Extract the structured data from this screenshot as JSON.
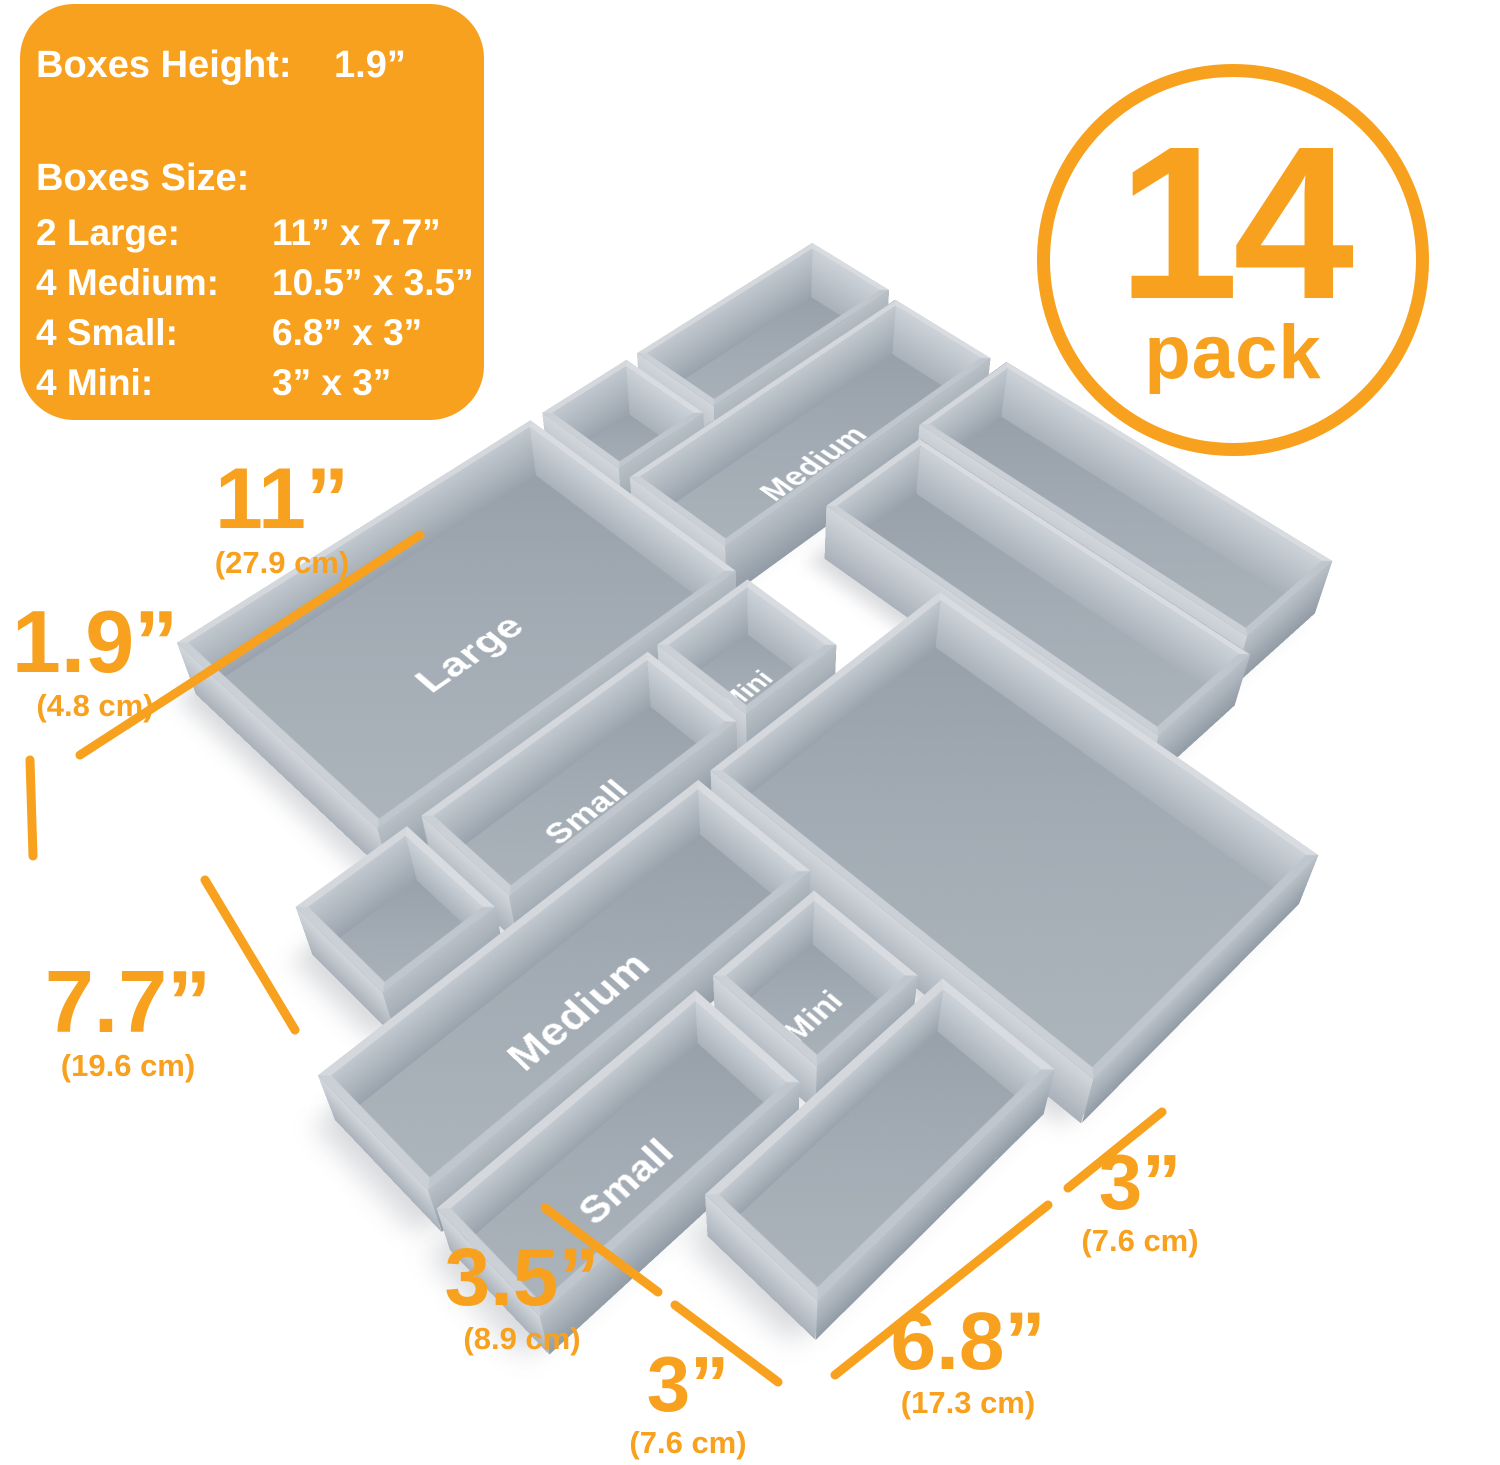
{
  "info_panel": {
    "height_label": "Boxes Height:",
    "height_value": "1.9”",
    "size_label": "Boxes Size:",
    "rows": [
      {
        "label": "2 Large:",
        "value": "11” x 7.7”"
      },
      {
        "label": "4 Medium:",
        "value": "10.5” x 3.5”"
      },
      {
        "label": "4 Small:",
        "value": "6.8” x 3”"
      },
      {
        "label": "4 Mini:",
        "value": "3” x 3”"
      }
    ]
  },
  "badge": {
    "count": "14",
    "unit": "pack"
  },
  "colors": {
    "accent": "#F7A11E",
    "box_gray": "#a9b2ba",
    "label_text": "#ffffff",
    "background": "#ffffff"
  },
  "boxes": [
    {
      "name": "small-top-left",
      "type": "small",
      "label": "",
      "x": 0,
      "y": 0,
      "w": 3,
      "h": 6.8
    },
    {
      "name": "mini-top-left",
      "type": "mini",
      "label": "",
      "x": 0,
      "y": 7.2,
      "w": 3,
      "h": 3
    },
    {
      "name": "large-left",
      "type": "large",
      "label": "Large",
      "x": 0,
      "y": 10.6,
      "w": 7.7,
      "h": 11
    },
    {
      "name": "medium-center-left",
      "type": "medium",
      "label": "Medium",
      "x": 3.4,
      "y": 0.2,
      "w": 3.5,
      "h": 10
    },
    {
      "name": "medium-top",
      "type": "medium",
      "label": "",
      "x": 7.3,
      "y": 0,
      "w": 10.5,
      "h": 3.5
    },
    {
      "name": "medium-upper-right",
      "type": "medium",
      "label": "",
      "x": 7.7,
      "y": 3.9,
      "w": 10.5,
      "h": 3.5
    },
    {
      "name": "large-right",
      "type": "large",
      "label": "",
      "x": 11.7,
      "y": 7.6,
      "w": 11,
      "h": 7.7
    },
    {
      "name": "mini-center",
      "type": "mini",
      "label": "Mini",
      "x": 8.1,
      "y": 10.6,
      "w": 3,
      "h": 3
    },
    {
      "name": "small-center",
      "type": "small",
      "label": "Small",
      "x": 8.1,
      "y": 13.9,
      "w": 3,
      "h": 6.8
    },
    {
      "name": "medium-lower-center",
      "type": "medium",
      "label": "Medium",
      "x": 11.7,
      "y": 15.7,
      "w": 3.5,
      "h": 10.5
    },
    {
      "name": "mini-bottom-left",
      "type": "mini",
      "label": "",
      "x": 8.1,
      "y": 21.1,
      "w": 3,
      "h": 3
    },
    {
      "name": "mini-bottom-right",
      "type": "mini",
      "label": "Mini",
      "x": 15.6,
      "y": 16.0,
      "w": 3,
      "h": 3
    },
    {
      "name": "small-bottom",
      "type": "small",
      "label": "Small",
      "x": 15.6,
      "y": 19.5,
      "w": 3,
      "h": 6.8
    },
    {
      "name": "small-right",
      "type": "small",
      "label": "",
      "x": 19.0,
      "y": 15.7,
      "w": 3,
      "h": 6.8
    }
  ],
  "dimensions": [
    {
      "name": "large-length-11in",
      "value": "11”",
      "cm": "(27.9 cm)",
      "x": 282,
      "y": 520,
      "vs": 86,
      "line": [
        80,
        755,
        420,
        535
      ]
    },
    {
      "name": "boxes-height-1-9in",
      "value": "1.9”",
      "cm": "(4.8 cm)",
      "x": 95,
      "y": 662,
      "vs": 88,
      "line": [
        30,
        760,
        33,
        856
      ]
    },
    {
      "name": "large-width-7-7in",
      "value": "7.7”",
      "cm": "(19.6 cm)",
      "x": 128,
      "y": 1022,
      "vs": 88,
      "line": [
        205,
        880,
        295,
        1030
      ]
    },
    {
      "name": "medium-width-3-5in",
      "value": "3.5”",
      "cm": "(8.9 cm)",
      "x": 522,
      "y": 1298,
      "vs": 82,
      "line": [
        545,
        1208,
        658,
        1292
      ]
    },
    {
      "name": "mini-width-3in",
      "value": "3”",
      "cm": "(7.6 cm)",
      "x": 688,
      "y": 1404,
      "vs": 78,
      "line": [
        675,
        1305,
        778,
        1382
      ]
    },
    {
      "name": "small-length-6-8in",
      "value": "6.8”",
      "cm": "(17.3 cm)",
      "x": 968,
      "y": 1362,
      "vs": 82,
      "line": [
        835,
        1375,
        1048,
        1205
      ]
    },
    {
      "name": "mini-width-3in-right",
      "value": "3”",
      "cm": "(7.6 cm)",
      "x": 1140,
      "y": 1202,
      "vs": 78,
      "line": [
        1068,
        1188,
        1162,
        1112
      ]
    }
  ]
}
